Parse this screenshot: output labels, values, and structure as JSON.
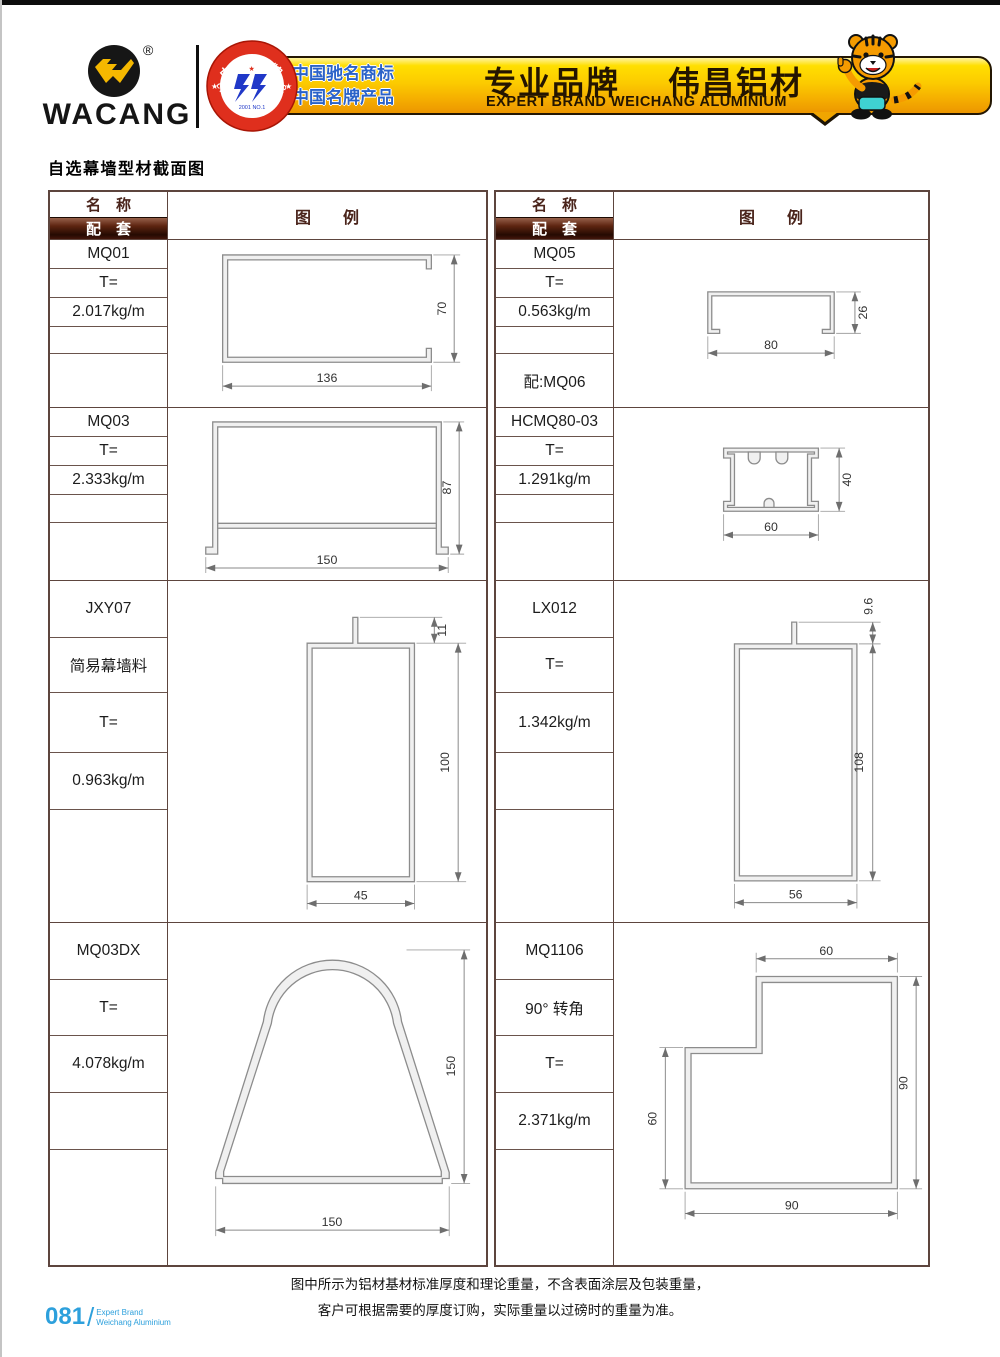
{
  "header": {
    "brand": "WACANG",
    "registered": "®",
    "badge": {
      "arc_top": "中国名牌",
      "arc_bottom": "CHINA TOP BRAND",
      "center_small": "2001 NO.1"
    },
    "banner": {
      "claim1": "中国驰名商标",
      "claim2": "中国名牌产品",
      "slogan": "专业品牌",
      "brand_cn": "伟昌铝材",
      "subtitle": "EXPERT BRAND WEICHANG ALUMINIUM"
    }
  },
  "title": "自选幕墙型材截面图",
  "table_header": {
    "name": "名　称",
    "match": "配　套",
    "legend": "图　　例"
  },
  "profiles": {
    "mq01": {
      "name": "MQ01",
      "t": "T=",
      "weight": "2.017kg/m",
      "dim_w": "136",
      "dim_h": "70"
    },
    "mq03": {
      "name": "MQ03",
      "t": "T=",
      "weight": "2.333kg/m",
      "dim_w": "150",
      "dim_h": "87"
    },
    "jxy07": {
      "name": "JXY07",
      "desc": "简易幕墙料",
      "t": "T=",
      "weight": "0.963kg/m",
      "dim_w": "45",
      "dim_h": "100",
      "dim_fin": "11"
    },
    "mq03dx": {
      "name": "MQ03DX",
      "t": "T=",
      "weight": "4.078kg/m",
      "dim_w": "150",
      "dim_h": "150"
    },
    "mq05": {
      "name": "MQ05",
      "t": "T=",
      "weight": "0.563kg/m",
      "match": "配:MQ06",
      "dim_w": "80",
      "dim_h": "26"
    },
    "hcmq80": {
      "name": "HCMQ80-03",
      "t": "T=",
      "weight": "1.291kg/m",
      "dim_w": "60",
      "dim_h": "40"
    },
    "lx012": {
      "name": "LX012",
      "t": "T=",
      "weight": "1.342kg/m",
      "dim_w": "56",
      "dim_h": "108",
      "dim_fin": "9.6"
    },
    "mq1106": {
      "name": "MQ1106",
      "desc": "90° 转角",
      "t": "T=",
      "weight": "2.371kg/m",
      "dim_w": "90",
      "dim_h": "90",
      "dim_top": "60",
      "dim_left": "60"
    }
  },
  "footer": {
    "line1": "图中所示为铝材基材标准厚度和理论重量，不含表面涂层及包装重量，",
    "line2": "客户可根据需要的厚度订购，实际重量以过磅时的重量为准。"
  },
  "page_number": {
    "number": "081",
    "divider": "/",
    "caption1": "Expert Brand",
    "caption2": "Weichang Aluminium"
  },
  "colors": {
    "accent_gold": "#f7b500",
    "brand_red": "#e03020",
    "table_border": "#5d453e",
    "band_brown": "#3a1408",
    "page_blue": "#2da0dc",
    "dim_line": "#8a8a8a"
  }
}
